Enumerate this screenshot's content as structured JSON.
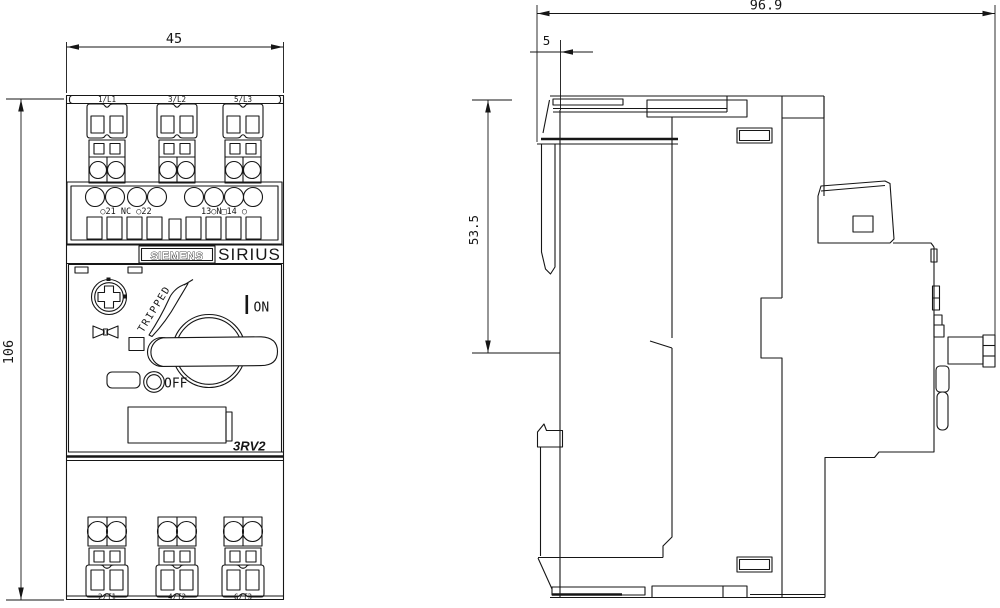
{
  "dimensions": {
    "front_width": "45",
    "front_height": "106",
    "side_depth": "96.9",
    "rail_clip_offset": "5",
    "upper_section_height": "53.5"
  },
  "front_view": {
    "brand": "SIEMENS",
    "series": "SIRIUS",
    "model": "3RV2",
    "top_terminals": [
      "1/L1",
      "3/L2",
      "5/L3"
    ],
    "bottom_terminals": [
      "2/T1",
      "4/T2",
      "6/T3"
    ],
    "aux_contacts_left": "○21 NC ○22",
    "aux_contacts_right": "13○N□14 ○",
    "switch_labels": {
      "tripped": "TRIPPED",
      "on": "ON",
      "off": "OFF"
    }
  }
}
